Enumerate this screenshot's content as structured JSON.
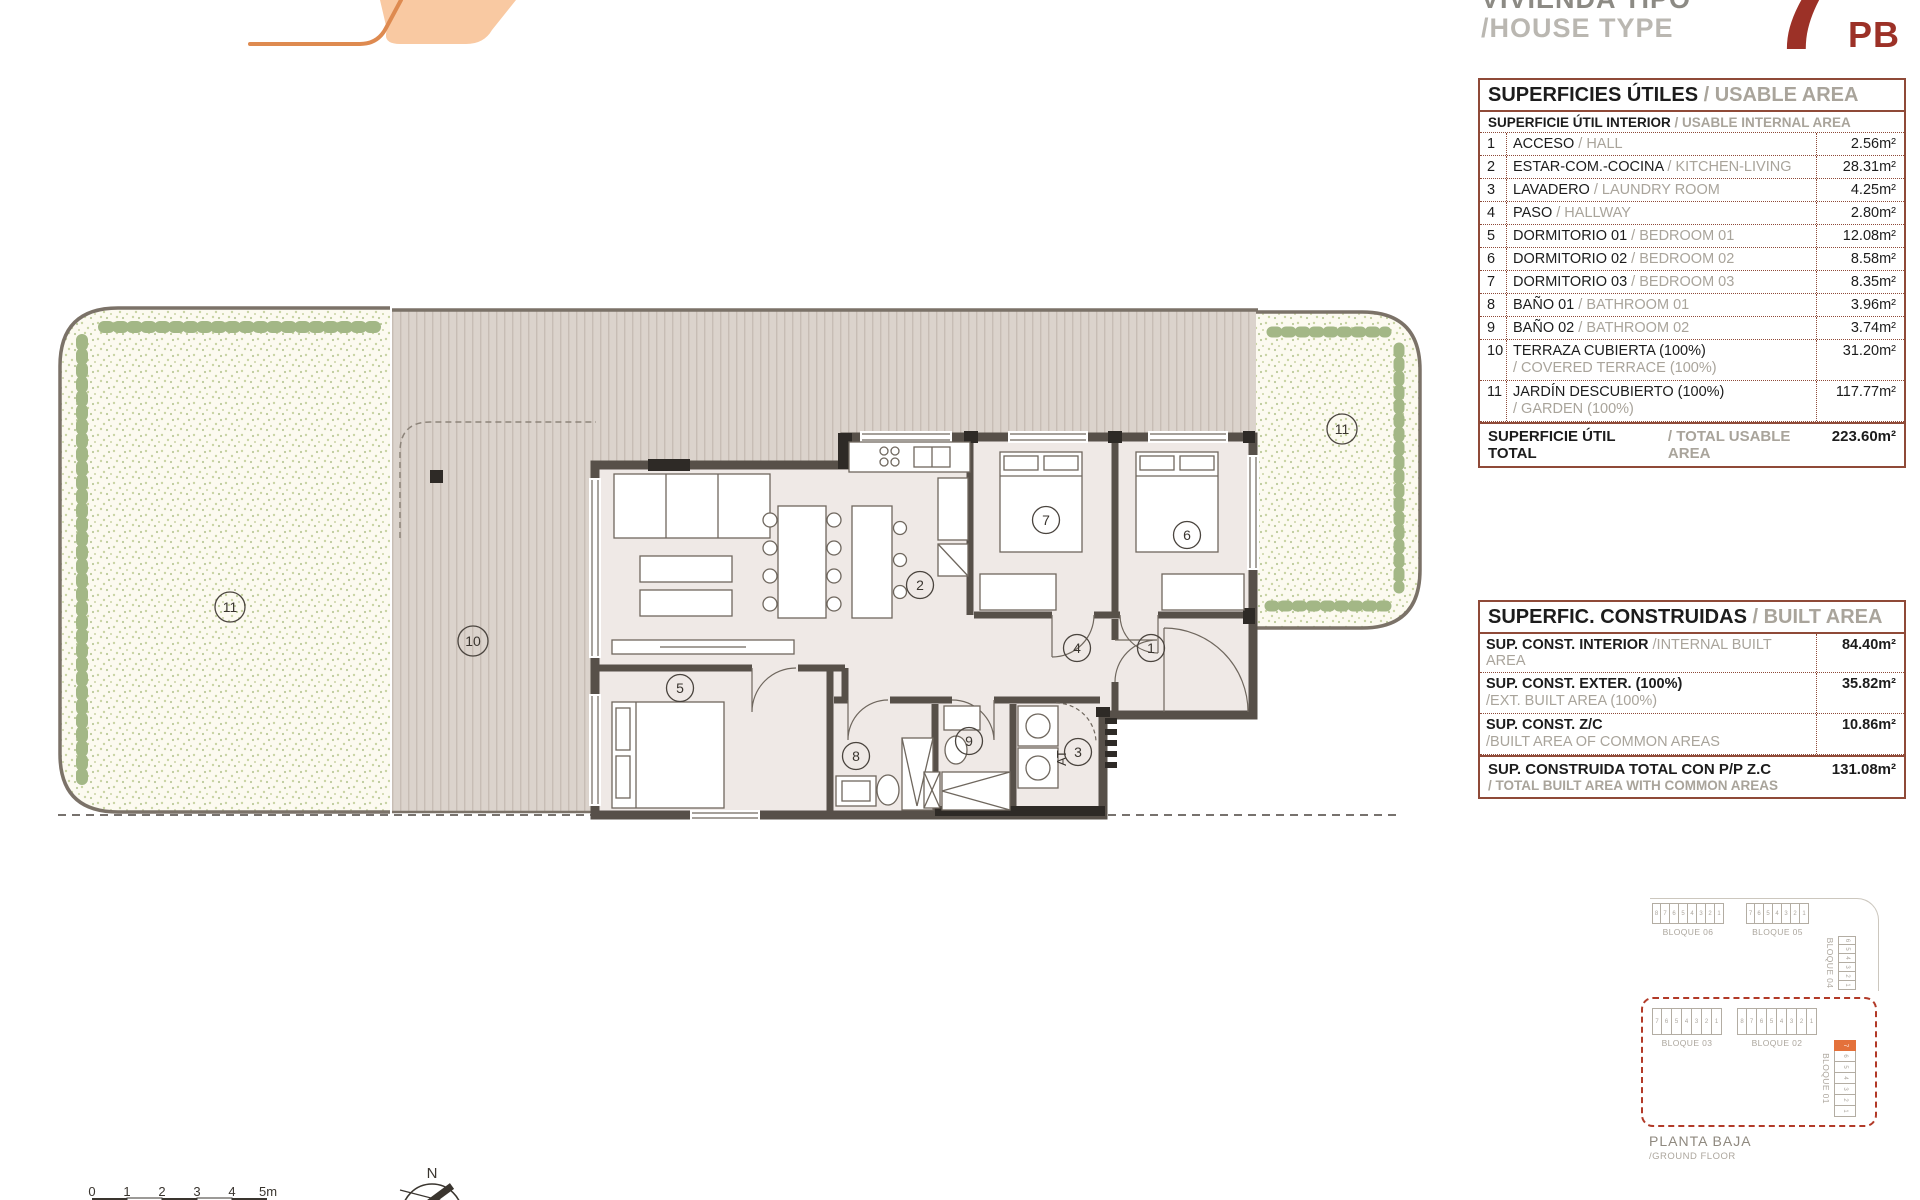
{
  "header": {
    "title_es": "VIVIENDA TIPO",
    "title_en": "/HOUSE TYPE",
    "unit_number": "7",
    "floor_code": "PB"
  },
  "usable_table": {
    "title_es": "SUPERFICIES ÚTILES",
    "title_en": "/ USABLE AREA",
    "subtitle_es": "SUPERFICIE ÚTIL INTERIOR",
    "subtitle_en": "/ USABLE INTERNAL AREA",
    "rows": [
      {
        "num": "1",
        "es": "ACCESO",
        "en": "/ HALL",
        "value": "2.56m²"
      },
      {
        "num": "2",
        "es": "ESTAR-COM.-COCINA",
        "en": "/ KITCHEN-LIVING",
        "value": "28.31m²"
      },
      {
        "num": "3",
        "es": "LAVADERO",
        "en": "/ LAUNDRY ROOM",
        "value": "4.25m²"
      },
      {
        "num": "4",
        "es": "PASO",
        "en": "/ HALLWAY",
        "value": "2.80m²"
      },
      {
        "num": "5",
        "es": "DORMITORIO 01",
        "en": "/ BEDROOM 01",
        "value": "12.08m²"
      },
      {
        "num": "6",
        "es": "DORMITORIO 02",
        "en": "/ BEDROOM 02",
        "value": "8.58m²"
      },
      {
        "num": "7",
        "es": "DORMITORIO 03",
        "en": "/ BEDROOM 03",
        "value": "8.35m²"
      },
      {
        "num": "8",
        "es": "BAÑO 01",
        "en": "/ BATHROOM 01",
        "value": "3.96m²"
      },
      {
        "num": "9",
        "es": "BAÑO 02",
        "en": "/ BATHROOM 02",
        "value": "3.74m²"
      },
      {
        "num": "10",
        "es": "TERRAZA CUBIERTA (100%)",
        "en": "/ COVERED TERRACE (100%)",
        "value": "31.20m²"
      },
      {
        "num": "11",
        "es": "JARDÍN DESCUBIERTO (100%)",
        "en": "/ GARDEN (100%)",
        "value": "117.77m²"
      }
    ],
    "total_es": "SUPERFICIE ÚTIL TOTAL",
    "total_en": "/ TOTAL USABLE AREA",
    "total_value": "223.60m²"
  },
  "built_table": {
    "title_es": "SUPERFIC. CONSTRUIDAS",
    "title_en": "/ BUILT AREA",
    "rows": [
      {
        "es": "SUP. CONST. INTERIOR",
        "en": "/INTERNAL BUILT AREA",
        "value": "84.40m²"
      },
      {
        "es": "SUP. CONST. EXTER. (100%)",
        "en": "/EXT. BUILT AREA (100%)",
        "value": "35.82m²"
      },
      {
        "es": "SUP. CONST. Z/C",
        "en": "/BUILT AREA OF COMMON AREAS",
        "value": "10.86m²"
      }
    ],
    "total_es": "SUP. CONSTRUIDA TOTAL CON P/P Z.C",
    "total_en": "/ TOTAL BUILT AREA WITH COMMON AREAS",
    "total_value": "131.08m²"
  },
  "plan": {
    "rooms": {
      "r1": "1",
      "r2": "2",
      "r3": "3",
      "r4": "4",
      "r5": "5",
      "r6": "6",
      "r7": "7",
      "r8": "8",
      "r9": "9",
      "r10": "10",
      "r11": "11"
    },
    "at_label": "AT"
  },
  "keyplan": {
    "blocks": {
      "b01": "BLOQUE 01",
      "b02": "BLOQUE 02",
      "b03": "BLOQUE 03",
      "b04": "BLOQUE 04",
      "b05": "BLOQUE 05",
      "b06": "BLOQUE 06"
    },
    "cells8": [
      "8",
      "7",
      "6",
      "5",
      "4",
      "3",
      "2",
      "1"
    ],
    "cells7": [
      "7",
      "6",
      "5",
      "4",
      "3",
      "2",
      "1"
    ],
    "cells6": [
      "6",
      "5",
      "4",
      "3",
      "2",
      "1"
    ],
    "cells_b01": [
      "7",
      "6",
      "5",
      "4",
      "3",
      "2",
      "1"
    ],
    "floor_es": "PLANTA BAJA",
    "floor_en": "/GROUND FLOOR"
  },
  "scalebar": {
    "ticks": [
      "0",
      "1",
      "2",
      "3",
      "4",
      "5m"
    ]
  },
  "compass": {
    "north": "N"
  },
  "colors": {
    "accent_red": "#9C3127",
    "table_border": "#8F4A38",
    "logo_peach": "#F9C9A2",
    "logo_orange": "#DE8A50",
    "highlight_orange": "#E4713B",
    "keyplan_dash": "#B23A28",
    "wall": "#575049"
  }
}
